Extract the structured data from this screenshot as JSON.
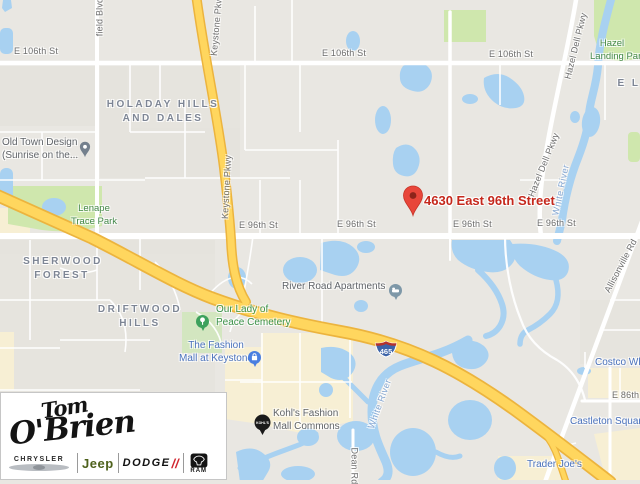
{
  "map": {
    "destination_label": "4630 East 96th Street",
    "pins": {
      "kohls": "KOHL'S",
      "interstate": "465"
    },
    "colors": {
      "water": "#a8d1f1",
      "park": "#cfe7ad",
      "commercial": "#f7efd4",
      "highway": "#ffd65e",
      "destination_red": "#c5281c",
      "marker_red": "#e8463a"
    },
    "labels": [
      {
        "t": "E 106th St",
        "x": 14,
        "y": 47,
        "k": "st"
      },
      {
        "t": "E 106th St",
        "x": 322,
        "y": 49,
        "k": "st"
      },
      {
        "t": "E 106th St",
        "x": 489,
        "y": 50,
        "k": "st"
      },
      {
        "t": "E 96th St",
        "x": 239,
        "y": 221,
        "k": "st"
      },
      {
        "t": "E 96th St",
        "x": 337,
        "y": 220,
        "k": "st"
      },
      {
        "t": "E 96th St",
        "x": 453,
        "y": 220,
        "k": "st"
      },
      {
        "t": "E 96th St",
        "x": 537,
        "y": 219,
        "k": "st"
      },
      {
        "t": "E 86th St",
        "x": 612,
        "y": 391,
        "k": "st"
      },
      {
        "t": "field Blvd",
        "x": 100,
        "y": 17,
        "r": -90,
        "a": "cc",
        "k": "st"
      },
      {
        "t": "Keystone Pkwy",
        "x": 217,
        "y": 24,
        "r": -85,
        "a": "cc",
        "k": "st"
      },
      {
        "t": "Keystone Pkwy",
        "x": 227,
        "y": 187,
        "r": -87,
        "a": "cc",
        "k": "st"
      },
      {
        "t": "Hazel Dell Pkwy",
        "x": 576,
        "y": 46,
        "r": -76,
        "a": "cc",
        "k": "st"
      },
      {
        "t": "Hazel Dell Pkwy",
        "x": 544,
        "y": 165,
        "r": -68,
        "a": "cc",
        "k": "st"
      },
      {
        "t": "Allisonville Rd",
        "x": 621,
        "y": 266,
        "r": -62,
        "a": "cc",
        "k": "st"
      },
      {
        "t": "Dean Rd",
        "x": 354,
        "y": 466,
        "r": 90,
        "a": "cc",
        "k": "st"
      },
      {
        "t": "White River",
        "x": 561,
        "y": 190,
        "r": -78,
        "a": "cc",
        "k": "wt"
      },
      {
        "t": "White River",
        "x": 380,
        "y": 404,
        "r": -70,
        "a": "cc",
        "k": "wt"
      },
      {
        "t": "HOLADAY HILLS",
        "x": 163,
        "y": 100,
        "a": "c",
        "k": "area"
      },
      {
        "t": "AND DALES",
        "x": 163,
        "y": 114,
        "a": "c",
        "k": "area"
      },
      {
        "t": "SHERWOOD",
        "x": 63,
        "y": 257,
        "a": "c",
        "k": "area"
      },
      {
        "t": "FOREST",
        "x": 62,
        "y": 271,
        "a": "c",
        "k": "area"
      },
      {
        "t": "DRIFTWOOD",
        "x": 140,
        "y": 305,
        "a": "c",
        "k": "area"
      },
      {
        "t": "HILLS",
        "x": 140,
        "y": 319,
        "a": "c",
        "k": "area"
      },
      {
        "t": "E L",
        "x": 629,
        "y": 79,
        "a": "c",
        "k": "area"
      },
      {
        "t": "Lenape",
        "x": 94,
        "y": 204,
        "a": "c",
        "k": "park"
      },
      {
        "t": "Trace Park",
        "x": 94,
        "y": 217,
        "a": "c",
        "k": "park"
      },
      {
        "t": "Hazel",
        "x": 612,
        "y": 39,
        "a": "c",
        "k": "park"
      },
      {
        "t": "Landing Park",
        "x": 618,
        "y": 52,
        "a": "c",
        "k": "park"
      },
      {
        "t": "Our Lady of",
        "x": 216,
        "y": 305,
        "k": "poig",
        "i": 1,
        "n": "poi-label-cemetery"
      },
      {
        "t": "Peace Cemetery",
        "x": 216,
        "y": 318,
        "k": "poig",
        "i": 1,
        "n": "poi-label-cemetery"
      },
      {
        "t": "Old Town Design",
        "x": 2,
        "y": 138,
        "k": "poi",
        "i": 1,
        "n": "poi-label-old-town-design"
      },
      {
        "t": "(Sunrise on the...",
        "x": 2,
        "y": 151,
        "k": "poi",
        "i": 1,
        "n": "poi-label-old-town-design"
      },
      {
        "t": "River Road Apartments",
        "x": 282,
        "y": 282,
        "k": "poi",
        "i": 1,
        "n": "poi-label-river-road-apartments"
      },
      {
        "t": "Kohl's Fashion",
        "x": 273,
        "y": 409,
        "k": "poi",
        "i": 1,
        "n": "poi-label-kohls"
      },
      {
        "t": "Mall Commons",
        "x": 273,
        "y": 422,
        "k": "poi",
        "i": 1,
        "n": "poi-label-kohls"
      },
      {
        "t": "The Fashion",
        "x": 216,
        "y": 341,
        "a": "c",
        "k": "poib",
        "i": 1,
        "n": "poi-label-fashion-mall"
      },
      {
        "t": "Mall at Keystone",
        "x": 216,
        "y": 354,
        "a": "c",
        "k": "poib",
        "i": 1,
        "n": "poi-label-fashion-mall"
      },
      {
        "t": "Costco Wholesale",
        "x": 595,
        "y": 358,
        "k": "poib",
        "i": 1,
        "n": "poi-label-costco"
      },
      {
        "t": "Castleton Square",
        "x": 570,
        "y": 417,
        "k": "poib",
        "i": 1,
        "n": "poi-label-castleton-square"
      },
      {
        "t": "Trader Joe's",
        "x": 527,
        "y": 460,
        "k": "poib",
        "i": 1,
        "n": "poi-label-trader-joes"
      },
      {
        "t": "4630 East 96th Street",
        "x": 424,
        "y": 194,
        "k": "dest",
        "i": 1,
        "n": "destination-label"
      }
    ]
  },
  "logo": {
    "signature_top": "Tom",
    "signature_bottom": "O'Brien",
    "chrysler": "CHRYSLER",
    "jeep": "Jeep",
    "dodge": "DODGE",
    "dodge_slashes": "//",
    "ram": "RAM"
  }
}
